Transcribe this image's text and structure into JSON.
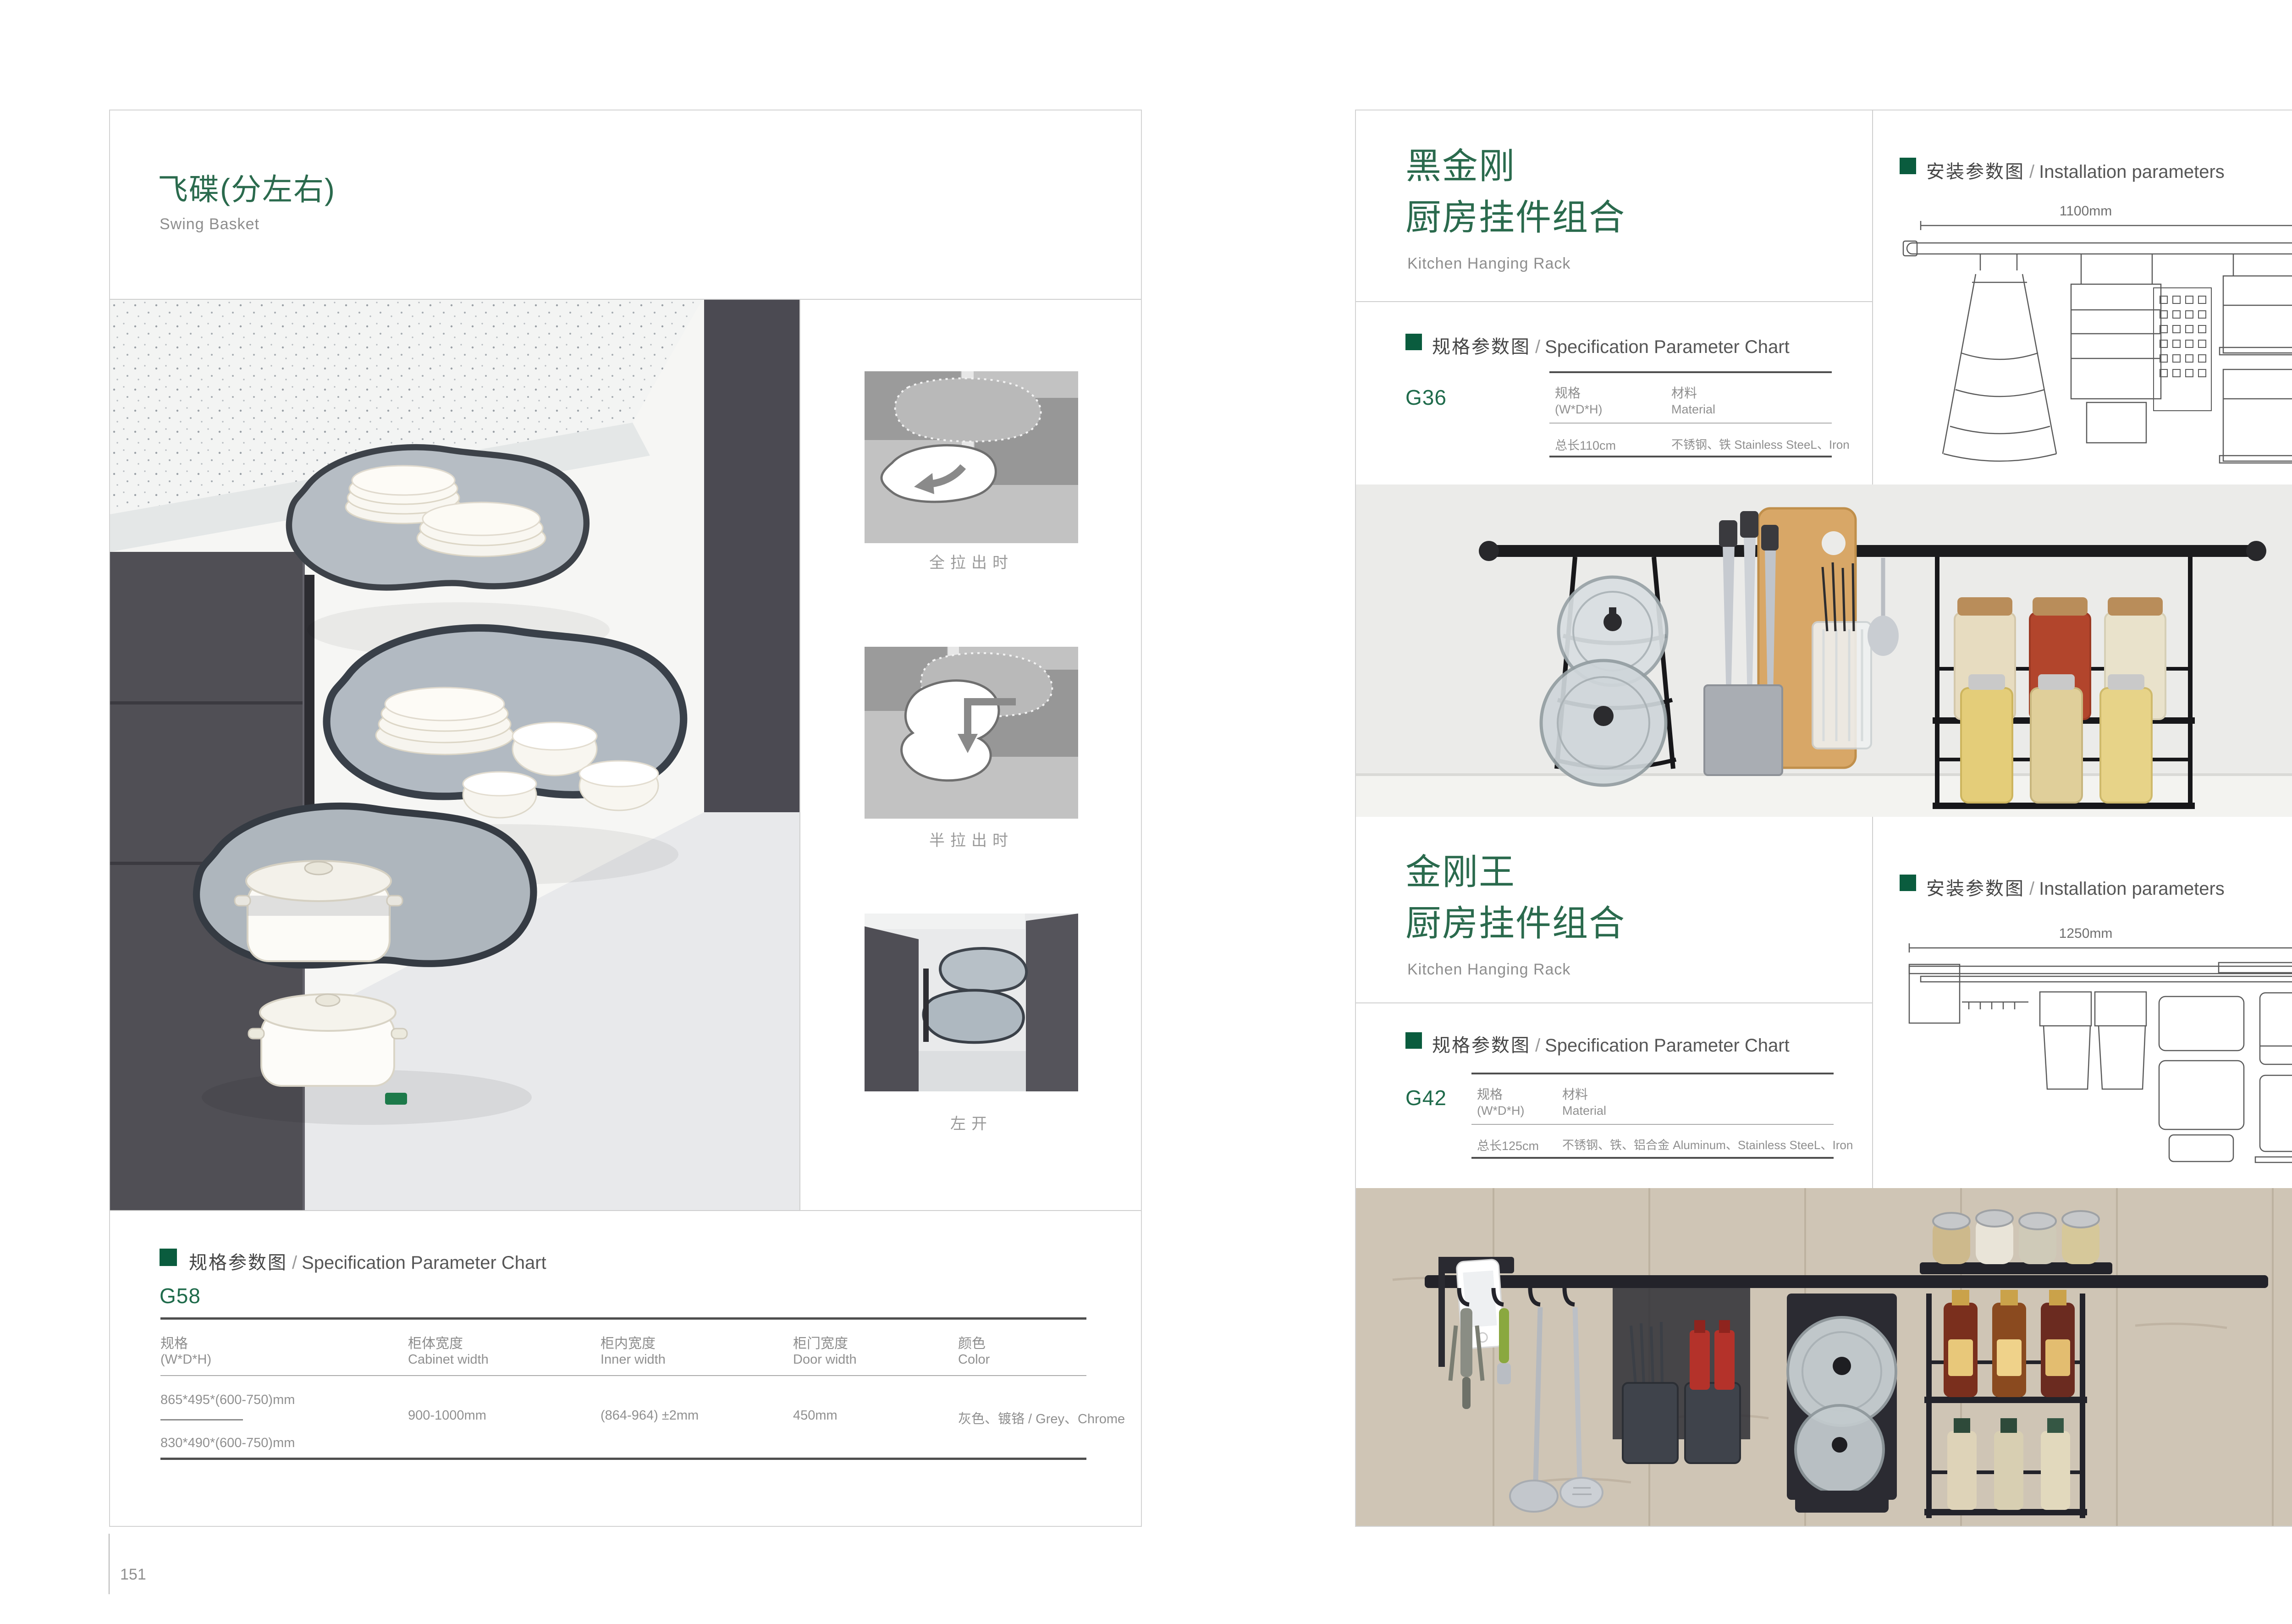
{
  "left_page": {
    "number": "151",
    "title": "飞碟(分左右)",
    "subtitle": "Swing Basket",
    "gallery": {
      "caption_full_pull": "全拉出时",
      "caption_half_pull": "半拉出时",
      "caption_left_open": "左开"
    },
    "spec": {
      "heading_cn": "规格参数图",
      "heading_sep": "/",
      "heading_en": "Specification Parameter Chart",
      "model": "G58",
      "columns": [
        {
          "cn": "规格",
          "en": "(W*D*H)"
        },
        {
          "cn": "柜体宽度",
          "en": "Cabinet width"
        },
        {
          "cn": "柜内宽度",
          "en": "Inner width"
        },
        {
          "cn": "柜门宽度",
          "en": "Door width"
        },
        {
          "cn": "颜色",
          "en": "Color"
        }
      ],
      "row": {
        "size_a": "865*495*(600-750)mm",
        "size_b": "830*490*(600-750)mm",
        "cabinet_width": "900-1000mm",
        "inner_width": "(864-964) ±2mm",
        "door_width": "450mm",
        "color": "灰色、镀铬 / Grey、Chrome"
      }
    }
  },
  "right_page": {
    "number": "152",
    "sections": [
      {
        "title_line1": "黑金刚",
        "title_line2": "厨房挂件组合",
        "subtitle": "Kitchen Hanging Rack",
        "spec": {
          "heading_cn": "规格参数图",
          "heading_sep": "/",
          "heading_en": "Specification Parameter Chart",
          "model": "G36",
          "col_spec_cn": "规格",
          "col_spec_en": "(W*D*H)",
          "col_mat_cn": "材料",
          "col_mat_en": "Material",
          "value_spec": "总长110cm",
          "value_mat": "不锈钢、铁  Stainless SteeL、Iron"
        },
        "install": {
          "heading_cn": "安装参数图",
          "heading_sep": "/",
          "heading_en": "Installation parameters",
          "width_label": "1100mm",
          "height_label": "420mm"
        }
      },
      {
        "title_line1": "金刚王",
        "title_line2": "厨房挂件组合",
        "subtitle": "Kitchen Hanging Rack",
        "spec": {
          "heading_cn": "规格参数图",
          "heading_sep": "/",
          "heading_en": "Specification Parameter Chart",
          "model": "G42",
          "col_spec_cn": "规格",
          "col_spec_en": "(W*D*H)",
          "col_mat_cn": "材料",
          "col_mat_en": "Material",
          "value_spec": "总长125cm",
          "value_mat": "不锈钢、铁、铝合金  Aluminum、Stainless SteeL、Iron"
        },
        "install": {
          "heading_cn": "安装参数图",
          "heading_sep": "/",
          "heading_en": "Installation parameters",
          "width_label": "1250mm",
          "height_label": "430mm"
        }
      }
    ]
  }
}
